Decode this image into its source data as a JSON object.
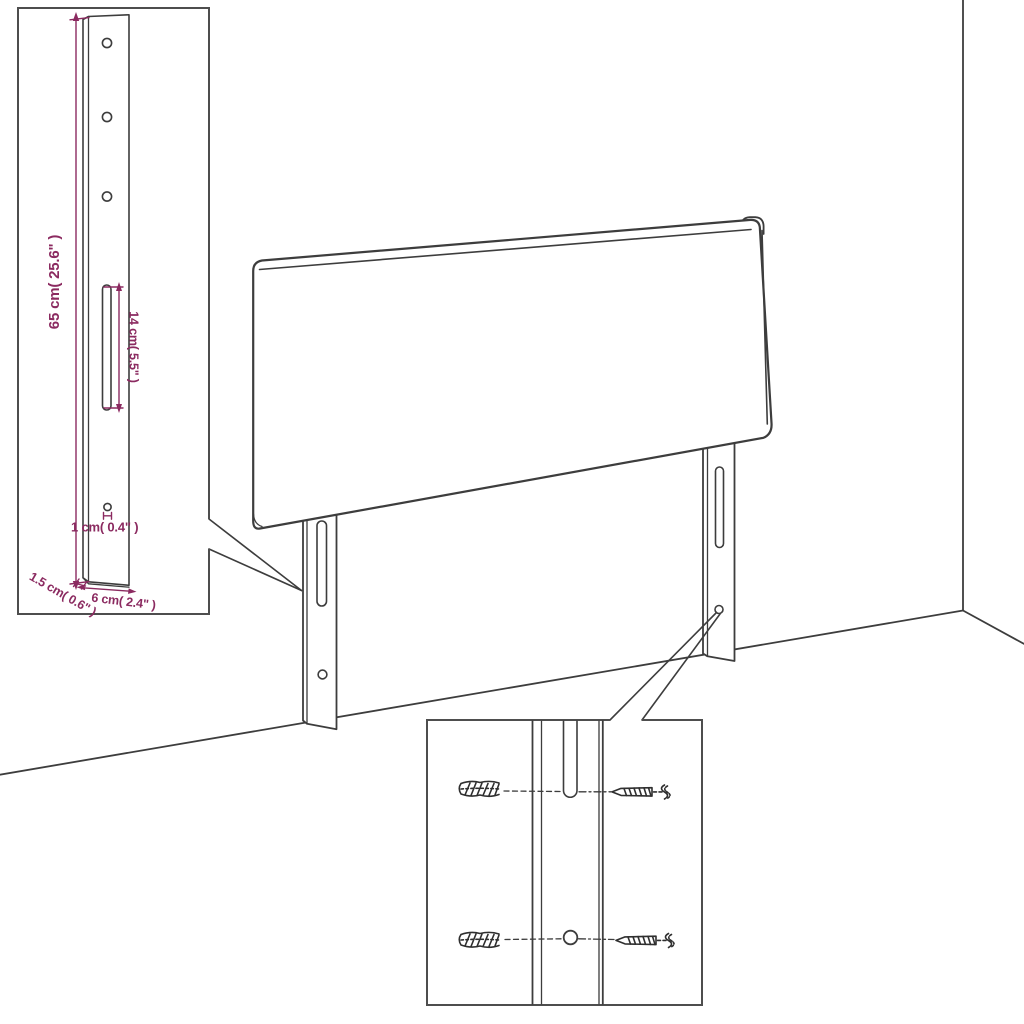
{
  "colors": {
    "line": "#3d3d3d",
    "box": "#4e4e4e",
    "dim": "#8b2a60",
    "bg": "#ffffff"
  },
  "bracket_callout": {
    "dim_height_label": "65 cm( 25.6\" )",
    "dim_slot_label": "14 cm( 5.5\" )",
    "dim_hole_label": "1 cm( 0.4\" )",
    "dim_thickness_label": "1.5 cm( 0.6\" )",
    "dim_width_label": "6 cm( 2.4\" )",
    "features": [
      "mounting-hole",
      "mounting-hole",
      "mounting-hole",
      "adjustment-slot",
      "screw-hole"
    ]
  },
  "hardware_callout": {
    "items": [
      "wall-plug",
      "screw",
      "wall-plug",
      "screw"
    ]
  },
  "scene": {
    "subject": "headboard-with-two-mounting-legs",
    "environment": "room-corner"
  }
}
